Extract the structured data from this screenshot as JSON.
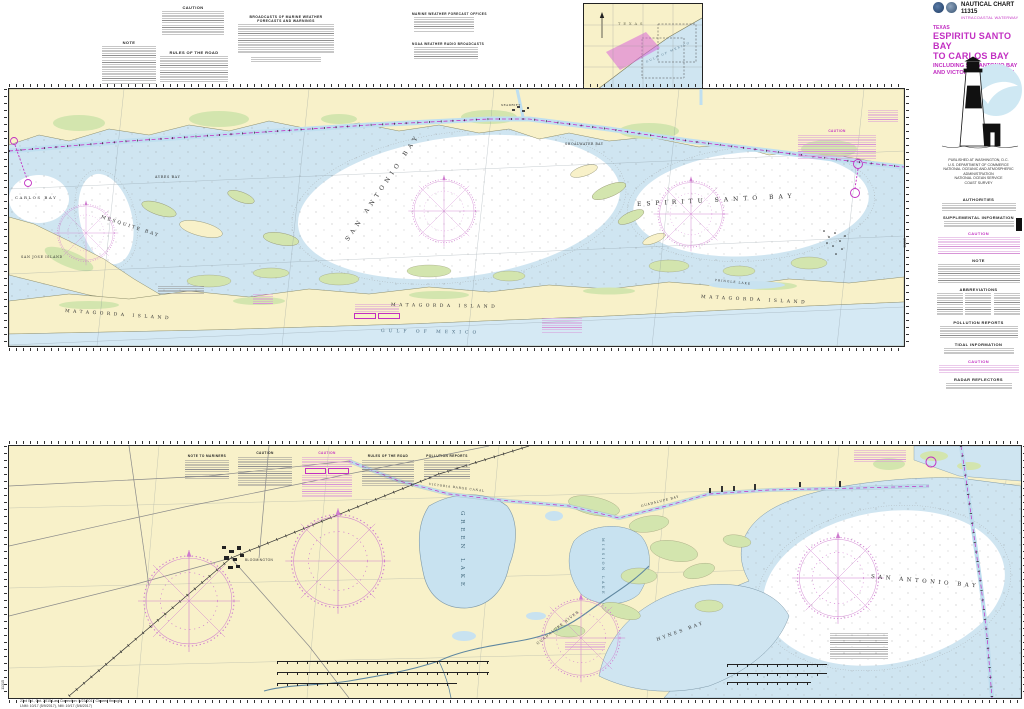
{
  "header": {
    "chart_number_label": "NAUTICAL CHART 11315",
    "series_label": "INTRACOASTAL WATERWAY",
    "state": "TEXAS",
    "title_line1": "ESPIRITU SANTO BAY",
    "title_line2": "TO CARLOS BAY",
    "subtitle_line1": "INCLUDING SAN ANTONIO BAY",
    "subtitle_line2": "AND VICTORIA BARGE CANAL"
  },
  "publisher": {
    "line1": "PUBLISHED AT WASHINGTON, D.C.",
    "line2": "U.S. DEPARTMENT OF COMMERCE",
    "line3": "NATIONAL OCEANIC AND ATMOSPHERIC ADMINISTRATION",
    "line4": "NATIONAL OCEAN SERVICE",
    "line5": "COAST SURVEY"
  },
  "right_margin": {
    "headings": [
      "AUTHORITIES",
      "SUPPLEMENTAL INFORMATION",
      "CAUTION",
      "NOTE",
      "ABBREVIATIONS",
      "POLLUTION REPORTS",
      "TIDAL INFORMATION",
      "CAUTION",
      "RADAR REFLECTORS"
    ]
  },
  "top_margin": {
    "note1_heading": "NOTE",
    "note2_heading": "CAUTION",
    "note3_heading": "RULES OF THE ROAD",
    "weather_table_title": "BROADCASTS OF MARINE WEATHER FORECASTS AND WARNINGS",
    "offices_table_title": "MARINE WEATHER FORECAST OFFICES",
    "radio_table_title": "NOAA WEATHER RADIO BROADCASTS"
  },
  "inset": {
    "state": "TEXAS",
    "water": "GULF OF MEXICO"
  },
  "upper_chart": {
    "labels": {
      "carlos_bay": "CARLOS BAY",
      "mesquite_bay": "MESQUITE BAY",
      "ayres_bay": "AYRES BAY",
      "san_jose_island": "SAN JOSE ISLAND",
      "san_antonio_bay": "SAN ANTONIO BAY",
      "shoalwater_bay": "SHOALWATER BAY",
      "espiritu_santo_bay": "ESPIRITU SANTO BAY",
      "pringle_lake": "PRINGLE LAKE",
      "matagorda_island": "MATAGORDA ISLAND",
      "gulf_of_mexico": "GULF OF MEXICO",
      "seadrift": "SEADRIFT",
      "caution_heading": "CAUTION",
      "note_heading": "NOTE"
    }
  },
  "lower_chart": {
    "labels": {
      "green_lake": "GREEN LAKE",
      "mission_lake": "MISSION LAKE",
      "guadalupe_bay": "GUADALUPE BAY",
      "guadalupe_river": "GUADALUPE RIVER",
      "hynes_bay": "HYNES BAY",
      "san_antonio_bay": "SAN ANTONIO BAY",
      "bloomington": "BLOOMINGTON",
      "victoria_barge_canal": "VICTORIA BARGE CANAL"
    },
    "notes_headings": [
      "NOTE TO MARINERS",
      "CAUTION",
      "CAUTION",
      "RULES OF THE ROAD",
      "POLLUTION REPORTS"
    ]
  },
  "footer": {
    "edition_line1": "23rd Ed., Oct. 2015   Last Correction: 5/23/2017   Cleared through",
    "edition_line2": "LNM: 10/17 (5/9/2017),  NM: 19/17 (5/6/2017)",
    "sheet_number": "11315"
  },
  "colors": {
    "magenta": "#c22fc2",
    "land_tan": "#f8f1c9",
    "marsh_green": "#d3e5ae",
    "shallow_blue": "#cfe5f1",
    "gulf_blue": "#d5e9f4"
  }
}
